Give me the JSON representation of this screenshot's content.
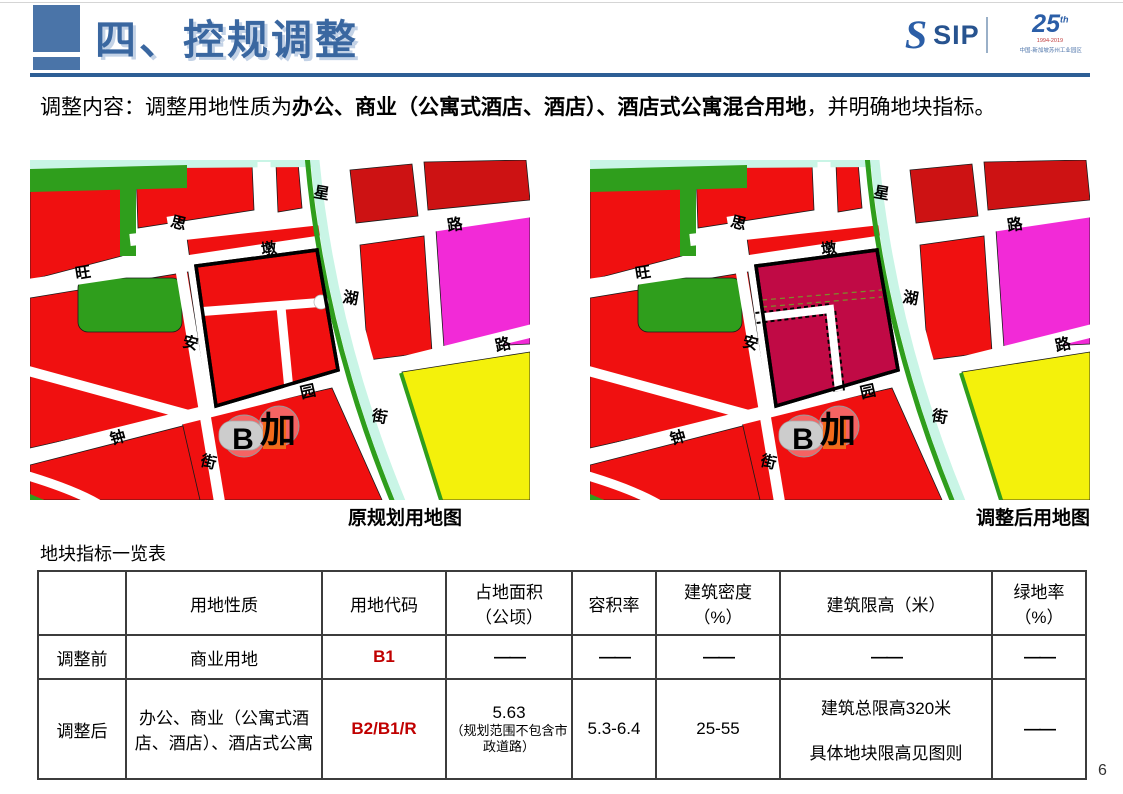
{
  "slide": {
    "page_number": "6"
  },
  "header": {
    "title": "四、控规调整",
    "logo": {
      "s_glyph": "S",
      "sip": "SIP",
      "anniversary": "25",
      "anniversary_sup": "th",
      "years": "1994-2019",
      "org": "中国-新加坡苏州工业园区"
    }
  },
  "intro": {
    "prefix": "调整内容：调整用地性质为",
    "bold": "办公、商业（公寓式酒店、酒店）、酒店式公寓混合用地",
    "suffix": "，并明确地块指标。"
  },
  "maps": {
    "left_caption": "原规划用地图",
    "right_caption": "调整后用地图",
    "labels": {
      "si": "思",
      "an": "安",
      "jie_s": "街",
      "wang": "旺",
      "dun": "墩",
      "lu_w": "路",
      "xing": "星",
      "hu": "湖",
      "jie_x": "街",
      "zhong": "钟",
      "yuan": "园",
      "lu_z": "路"
    },
    "markers": {
      "bus": "B",
      "gas": "加"
    }
  },
  "table": {
    "caption": "地块指标一览表",
    "headers": {
      "c0": "",
      "c1": "用地性质",
      "c2": "用地代码",
      "c3a": "占地面积",
      "c3b": "（公顷）",
      "c4": "容积率",
      "c5a": "建筑密度",
      "c5b": "（%）",
      "c6": "建筑限高（米）",
      "c7a": "绿地率",
      "c7b": "（%）"
    },
    "row_before": {
      "label": "调整前",
      "nature": "商业用地",
      "code": "B1",
      "area": "——",
      "far": "——",
      "density": "——",
      "height": "——",
      "green": "——"
    },
    "row_after": {
      "label": "调整后",
      "nature": "办公、商业（公寓式酒店、酒店）、酒店式公寓",
      "code": "B2/B1/R",
      "area_value": "5.63",
      "area_note": "（规划范围不包含市政道路）",
      "far": "5.3-6.4",
      "density": "25-55",
      "height_line1": "建筑总限高320米",
      "height_line2": "具体地块限高见图则",
      "green": "——"
    }
  },
  "colors": {
    "accent_blue": "#3a67a0",
    "rule_blue": "#2d5e95",
    "logo_blue": "#2b5ea7",
    "code_red": "#c00000",
    "parcel_red": "#f01010",
    "parcel_dark_red": "#cd1213",
    "parcel_crimson": "#c00a45",
    "parcel_green": "#2f9e1c",
    "parcel_magenta": "#f22ad7",
    "parcel_yellow": "#f4f10b",
    "water_cyan": "#c9f5e6",
    "marker_orange": "#f26a1b"
  }
}
